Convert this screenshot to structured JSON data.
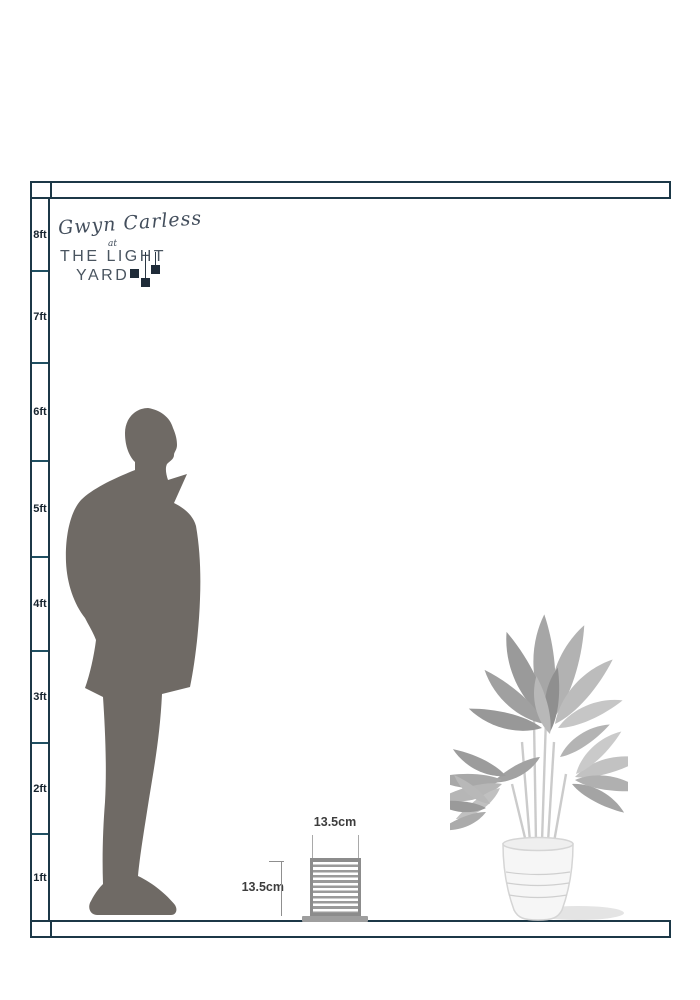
{
  "brand": {
    "script_name": "Gwyn Carless",
    "at_word": "at",
    "line1": "THE LIGHT",
    "line2": "YARD"
  },
  "ruler": {
    "labels": [
      "8ft",
      "7ft",
      "6ft",
      "5ft",
      "4ft",
      "3ft",
      "2ft",
      "1ft"
    ]
  },
  "product": {
    "width_label": "13.5cm",
    "height_label": "13.5cm"
  },
  "illustrations": {
    "man": "standing-man-silhouette",
    "plant": "potted-plant",
    "product": "louvered-cube-wall-light"
  },
  "colors": {
    "frame_border": "#1c3847",
    "ruler_tick": "#1f5062",
    "silhouette_gray": "#6f6a65",
    "lamp_gray": "#9a9a9a",
    "plant_gray": "#b0b0b0",
    "dimension_text": "#3d3d3d",
    "logo_navy": "#2a3744"
  }
}
